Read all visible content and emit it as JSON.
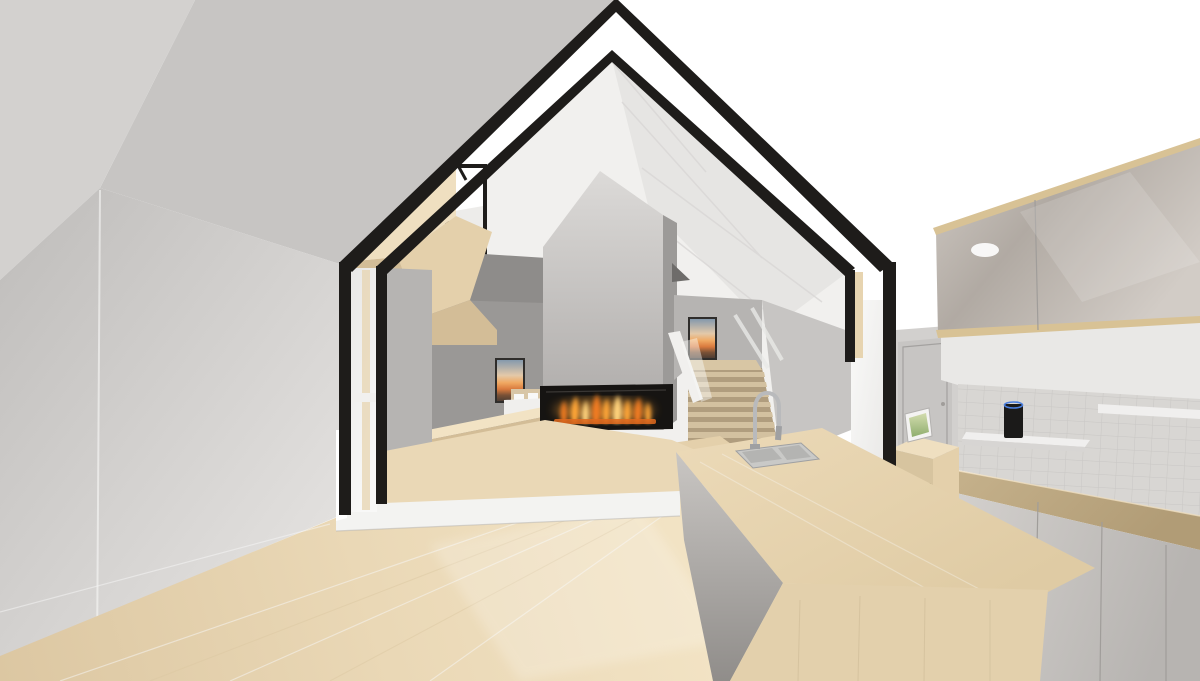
{
  "scene": {
    "kind": "3d-architectural-interior-rendering",
    "subject": "Open-plan gabled house interior with black A-frame structure, linear fireplace, stair to upper level, maple floors and modern kitchen island",
    "elements": [
      "black-gable-frame",
      "white-sky-through-glazing",
      "gray-ceiling-plane",
      "left-wall",
      "plywood-mezzanine-volume",
      "clerestory-window",
      "side-window",
      "bedroom-nook-with-bed",
      "sunset-artwork-left",
      "concrete-chimney-volume",
      "linear-gas-fireplace-with-flames",
      "stair-with-timber-treads",
      "sunset-artwork-stair",
      "glass-balustrade",
      "kitchen-upper-cabinets",
      "tiled-backsplash",
      "floating-shelves",
      "smart-speaker",
      "base-cabinets-with-wood-counter",
      "interior-door",
      "tablet-on-wood-cabinet",
      "kitchen-island-waterfall-wood",
      "double-stainless-sink",
      "gooseneck-faucet",
      "maple-timber-floor",
      "white-floor-step-band"
    ]
  },
  "colors": {
    "sky": "#ffffff",
    "frame_black": "#1e1c1a",
    "ceiling_main": "#c7c5c3",
    "ceiling_left": "#d3d1cf",
    "wall_left_dark": "#bebcba",
    "wall_left_light": "#e9e7e5",
    "side_wall": "#b6b4b2",
    "interior_white": "#f1f0ee",
    "interior_shade": "#e4e3e1",
    "facet_line": "#d8d6d4",
    "notch_dark": "#6e6c6a",
    "behind_wall_dark": "#8e8c8a",
    "bedroom_wall": "#9a9896",
    "chimney_top": "#dcdad8",
    "chimney_bottom": "#aba8a6",
    "chimney_side": "#9c9a98",
    "fireplace_black": "#161412",
    "firebox_lip": "#3a3734",
    "ember": "#e06a1e",
    "flame_deep": "#f07c22",
    "flame_mid": "#ffa638",
    "flame_core": "#ffd27c",
    "wood_bright": "#efdfc0",
    "wood_mid": "#e4d0ab",
    "wood_dark": "#d3bd97",
    "wood_strip": "#e7d4b0",
    "floor_dark": "#dcc7a2",
    "floor_mid": "#ead8b6",
    "floor_light": "#f2e3c4",
    "step_white": "#f3f3f1",
    "tread": "#d3c1a0",
    "riser": "#b09d7e",
    "landing": "#d8c6a4",
    "rail_white": "#f1f0ee",
    "art_top": "#7e96ad",
    "art_haze": "#e3c9a9",
    "art_glow": "#f0a963",
    "art_orange": "#d97a3e",
    "art_dusk": "#7a5136",
    "art_ground": "#453932",
    "frame_dark": "#2f2d2b",
    "bed_white": "#f0efed",
    "headboard": "#d8c6a6",
    "gloss_light": "#d2ccc6",
    "gloss_dark": "#b1aaa3",
    "cab_trim": "#d8c295",
    "tile": "#d8d6d3",
    "tile_line": "#c9c7c4",
    "wall_above_tile": "#e9e8e6",
    "counter_wood": "#c9b58f",
    "counter_wood_dark": "#b19c76",
    "base_light": "#d7d4d1",
    "base_dark": "#b7b4b1",
    "seam": "#a09d9a",
    "door_gray": "#c7c5c3",
    "door_wall": "#d2d0ce",
    "door_frame": "#a3a19f",
    "white_wall": "#fafaf9",
    "shelf": "#f0efee",
    "shelf_front": "#d7d5d3",
    "speaker": "#1b1a19",
    "speaker_ring": "#4a7fe0",
    "steel": "#b9babc",
    "steel_dark": "#9fa0a2",
    "sink_steel": "#c9c9c7",
    "sink_inner": "#b4b4b2",
    "island_top": "#ecdab8",
    "island_top_dark": "#dfcba4",
    "island_end": "#e3d0ac",
    "island_gloss_a": "#c9c6c3",
    "island_gloss_b": "#908d8a",
    "drawer_wood": "#d7c49f",
    "tablet_white": "#f4f3f2",
    "photo_a": "#d3dcae",
    "photo_b": "#8fae6e",
    "glass_a": "#e8e7e5",
    "glass_b": "#f8f8f7",
    "shadow_line": "#b3b1af"
  }
}
